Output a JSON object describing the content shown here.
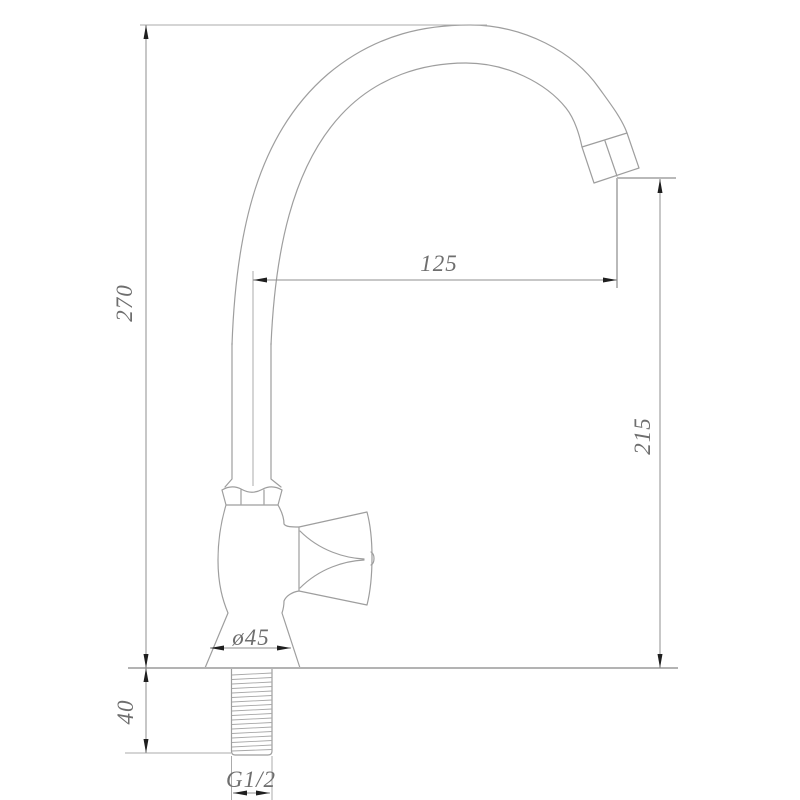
{
  "drawing": {
    "kind": "faucet-dimension-drawing",
    "labels": {
      "overall_height": "270",
      "spout_reach": "125",
      "spout_height": "215",
      "base_diameter": "ø45",
      "shank_length": "40",
      "thread_size": "G1/2"
    },
    "colors": {
      "background": "#ffffff",
      "outline": "#9e9e9e",
      "dimension_line": "#8f8f8f",
      "arrow": "#1f1f1f",
      "text": "#6e6e6e"
    }
  }
}
